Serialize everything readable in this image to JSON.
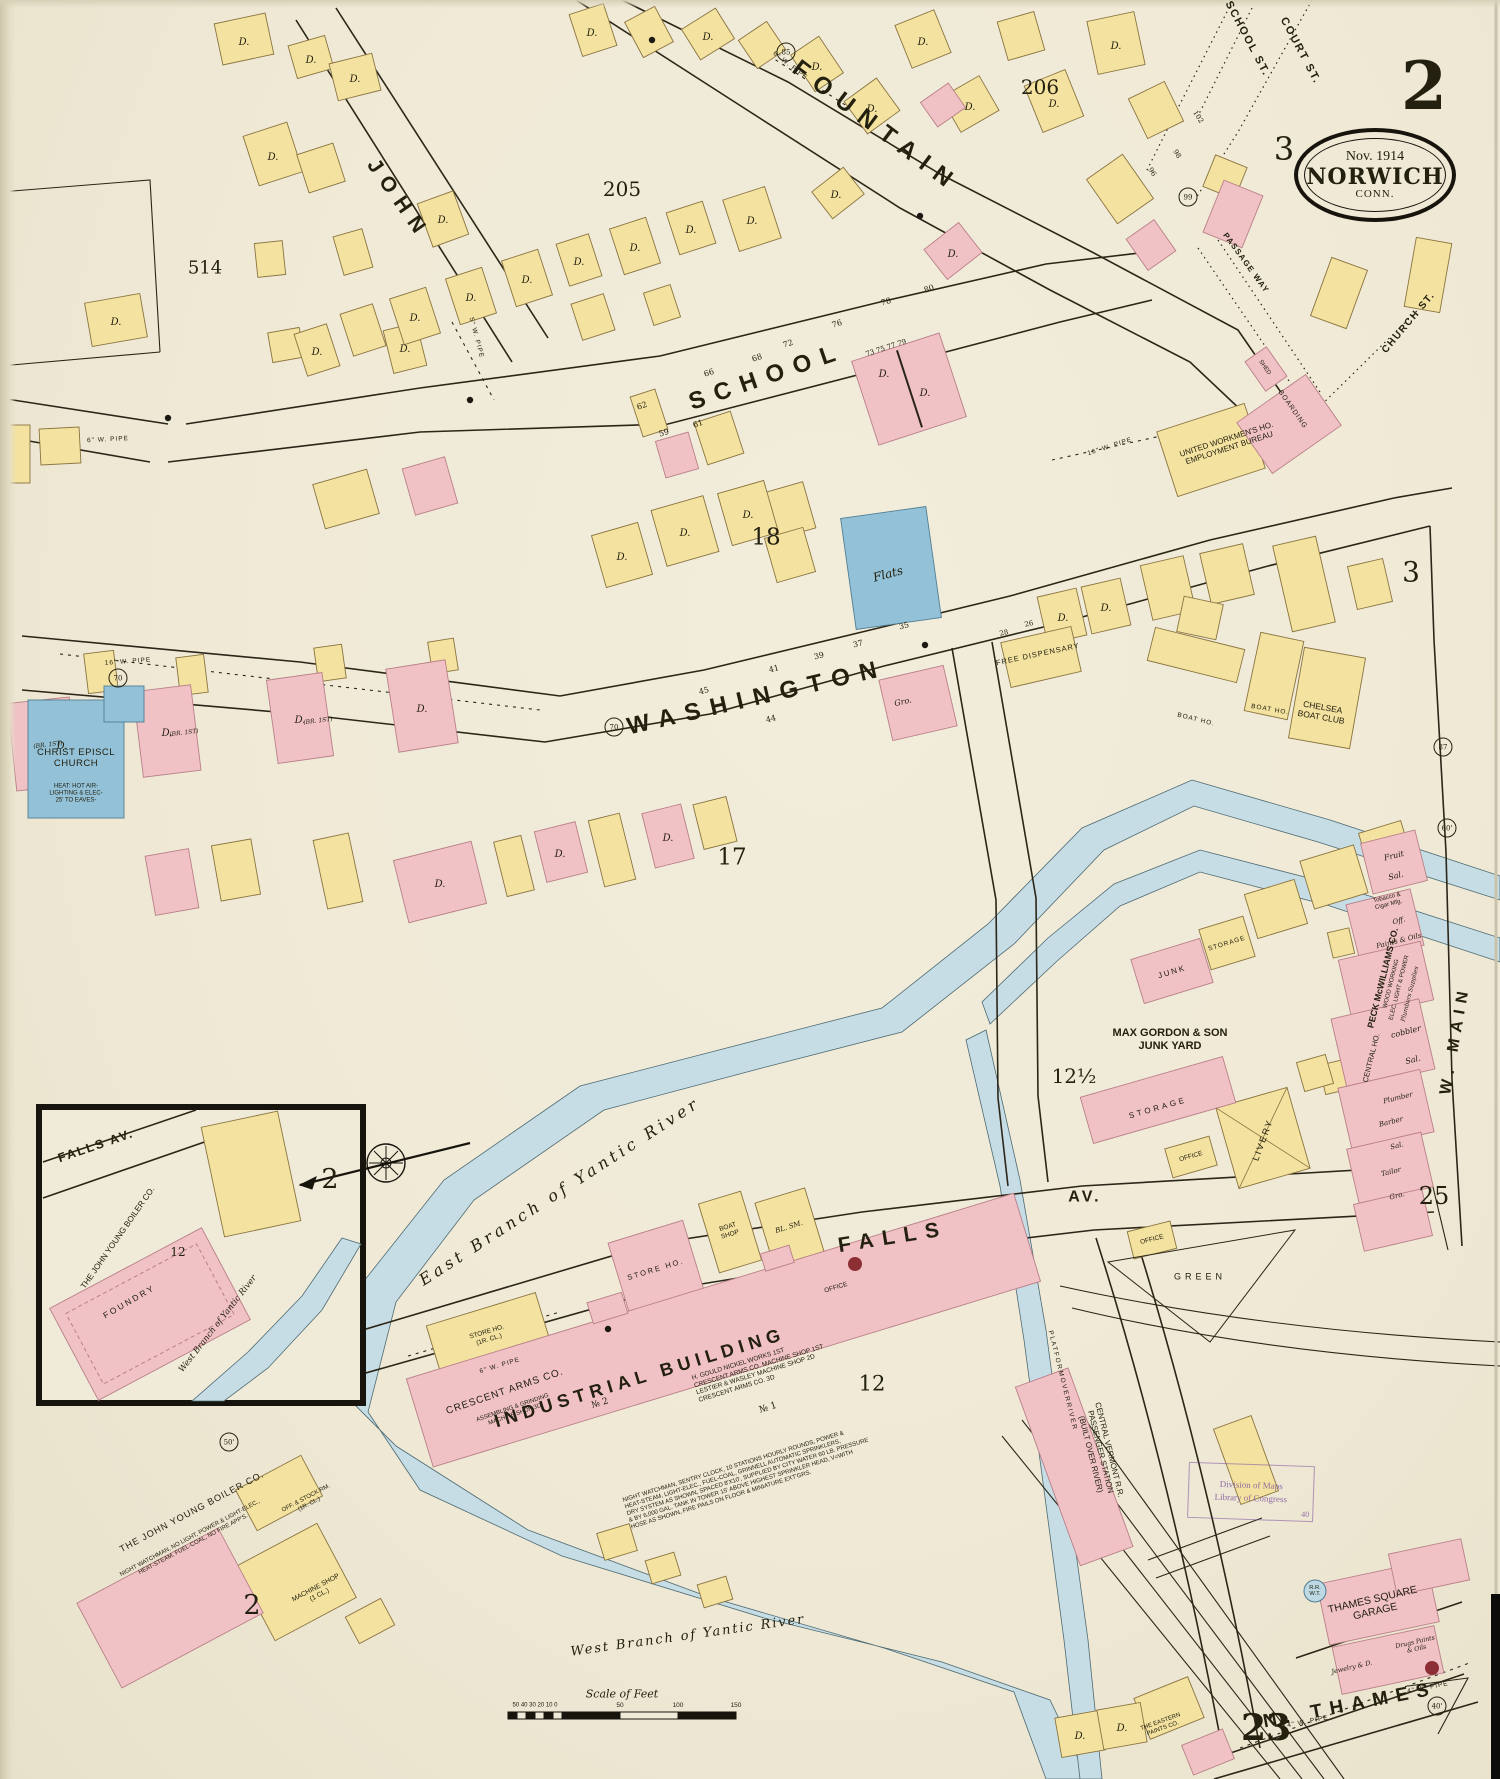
{
  "sheet": {
    "number": "2",
    "badge_date": "Nov. 1914",
    "badge_city": "NORWICH",
    "badge_state": "CONN.",
    "index_top": "3",
    "index_right": "3",
    "index_lower_right": "25",
    "index_bottom": "23"
  },
  "streets": {
    "fountain": "FOUNTAIN",
    "john": "JOHN",
    "school": "SCHOOL",
    "washington": "WASHINGTON",
    "falls": "FALLS",
    "av": "AV.",
    "w_main": "W. MAIN",
    "n_thames": "N. THAMES",
    "school_st": "SCHOOL ST.",
    "court_st": "COURT ST.",
    "church_st": "CHURCH ST.",
    "passage_way": "PASSAGE WAY",
    "falls_av_inset": "FALLS  AV."
  },
  "rivers": {
    "east_branch": "East Branch of Yantic River",
    "west_branch": "West Branch of Yantic River",
    "west_branch_inset": "West Branch of Yantic River"
  },
  "blocks": {
    "n206": "206",
    "n205": "205",
    "n514": "514",
    "n18": "18",
    "n17": "17",
    "n12half": "12½",
    "n12": "12",
    "n12_inset": "12",
    "n2_inset": "2",
    "n2_bottom": "2"
  },
  "pois": {
    "christ_church": "CHRIST EPISCL\nCHURCH",
    "christ_church_note": "HEAT: HOT AIR-\nLIGHTING & ELEC-\n25' TO EAVES-",
    "flats": "Flats",
    "free_dispensary": "FREE DISPENSARY",
    "gro_small": "Gro.",
    "united_workmens": "UNITED WORKMEN'S HO.\nEMPLOYMENT BUREAU",
    "boarding": "BOARDING",
    "shed": "SHED",
    "chelsea_boat_club": "CHELSEA\nBOAT CLUB",
    "boat_ho_1": "BOAT HO.",
    "boat_ho_2": "BOAT HO.",
    "max_gordon": "MAX GORDON & SON\nJUNK YARD",
    "junk": "JUNK",
    "storage_small": "STORAGE",
    "storage_big": "STORAGE",
    "office_livery": "OFFICE",
    "office_green": "OFFICE",
    "livery": "LIVERY",
    "green": "GREEN",
    "fruit": "Fruit",
    "sal_1": "Sal.",
    "tobacco": "Tobacco &\nCigar Mfg.",
    "off_small": "Off.",
    "paints_oils": "Paints & Oils",
    "peck_co": "PECK McWILLIAMS CO.",
    "peck_l1": "WOOD WORKING",
    "peck_l2": "ELEC. LIGHT & POWER",
    "peck_l3": "Plumbers Supplies",
    "central_ho": "CENTRAL HO.",
    "cobbler": "cobbler",
    "sal_2": "Sal.",
    "plumber": "Plumber",
    "barber": "Barber",
    "tailor": "Tailor",
    "sal_3": "Sal.",
    "gro_2": "Gro.",
    "industrial_building": "INDUSTRIAL BUILDING",
    "industrial_ann": "H. GOULD NICKEL WORKS 1ST\nCRESCENT ARMS CO. MACHINE SHOP 1ST\nLESTIER & WASLEY MACHINE SHOP 2D\nCRESCENT ARMS CO. 3D",
    "industrial_no1": "№ 1",
    "industrial_no2": "№ 2",
    "industrial_office": "OFFICE",
    "crescent_arms": "CRESCENT ARMS CO.",
    "crescent_sub": "ASSEMBLING & GRINDING\nMACHINE SHOP 3D",
    "crescent_notes": "NIGHT WATCHMAN, SENTRY CLOCK, 10 STATIONS HOURLY ROUNDS, POWER &\nHEAT-STEAM, LIGHT-ELEC., FUEL-COAL, GRINNELL AUTOMATIC SPRINKLERS,\nDRY SYSTEM AS SHOWN, SPACED 8'X10', SUPPLIED BY CITY WATER 60 LB. PRESSURE\n& BY 6,000 GAL. TANK IN TOWER 15' ABOVE HIGHEST SPRINKLER HEAD, V=WITH\nHOSE AS SHOWN, FIRE PAILS ON FLOOR & MINIATURE EXT'GRS.",
    "store_ho_pink": "STORE HO.",
    "store_ho_yellow": "STORE HO.\n(1R. CL.)",
    "boat_shop": "BOAT\nSHOP",
    "bl_sm": "BL. SM.",
    "cv_station": "CENTRAL VERMONT R.R.\nPASSENGER STATION\n(BUILT OVER RIVER)",
    "platform": "P L A T F O R M   O V E R   R I V E R",
    "john_young_inset": "THE JOHN YOUNG BOILER CO.",
    "foundry": "F O U N D R Y",
    "john_young_main": "THE JOHN YOUNG BOILER CO.",
    "john_young_notes": "NIGHT WATCHMAN, NO LIGHT, POWER & LIGHT-ELEC.,\nHEAT-STEAM, FUEL-COAL, NO FIRE APP'S.",
    "machine_shop": "MACHINE SHOP\n(1 CL.)",
    "off_stock": "OFF. & STOCK RM.\n(1R. CL.)",
    "thames_garage": "THAMES SQUARE\nGARAGE",
    "jewelry": "Jewelry & D.",
    "drugs": "Drugs Paints\n& Oils",
    "eastern_paints": "THE EASTERN\nPAINTS CO.",
    "rr_wt": "R.R.\nW.T."
  },
  "pipes": {
    "p6_fountain": "6\" W. PIPE",
    "p5_school": "5\" W. PIPE",
    "p6_left": "6\" W. PIPE",
    "p16_wash": "16\" W. PIPE",
    "p16_right": "16\" W. PIPE",
    "p6_falls": "6\" W. PIPE",
    "p4_thames_a": "4\" W. PIPE",
    "p4_thames_b": "4\" W. PIPE"
  },
  "nums": {
    "n62": "62",
    "n66": "66",
    "n68": "68",
    "n72": "72",
    "n76": "76",
    "n78": "78",
    "n80": "80",
    "n59": "59",
    "n61": "61",
    "row7": "73  75  77  79",
    "n35": "35",
    "n37": "37",
    "n39": "39",
    "n41": "41",
    "n44": "44",
    "n45": "45",
    "n28": "28",
    "n26": "26",
    "n96": "96",
    "n98": "98",
    "n102": "102"
  },
  "circles": {
    "c85": "85",
    "c99": "99",
    "c70a": "70",
    "c70b": "70",
    "c87": "87",
    "c50": "50'",
    "c40": "40'",
    "c60": "60'"
  },
  "scale": {
    "title": "Scale of Feet",
    "left_ticks": "50 40 30 20 10 0",
    "t50": "50",
    "t100": "100",
    "t150": "150"
  },
  "stamp": {
    "line1": "Division of Maps",
    "line2": "Library of Congress",
    "num": "40"
  },
  "marks": {
    "dwelling": "D.",
    "br": "(BR. 1ST)"
  }
}
